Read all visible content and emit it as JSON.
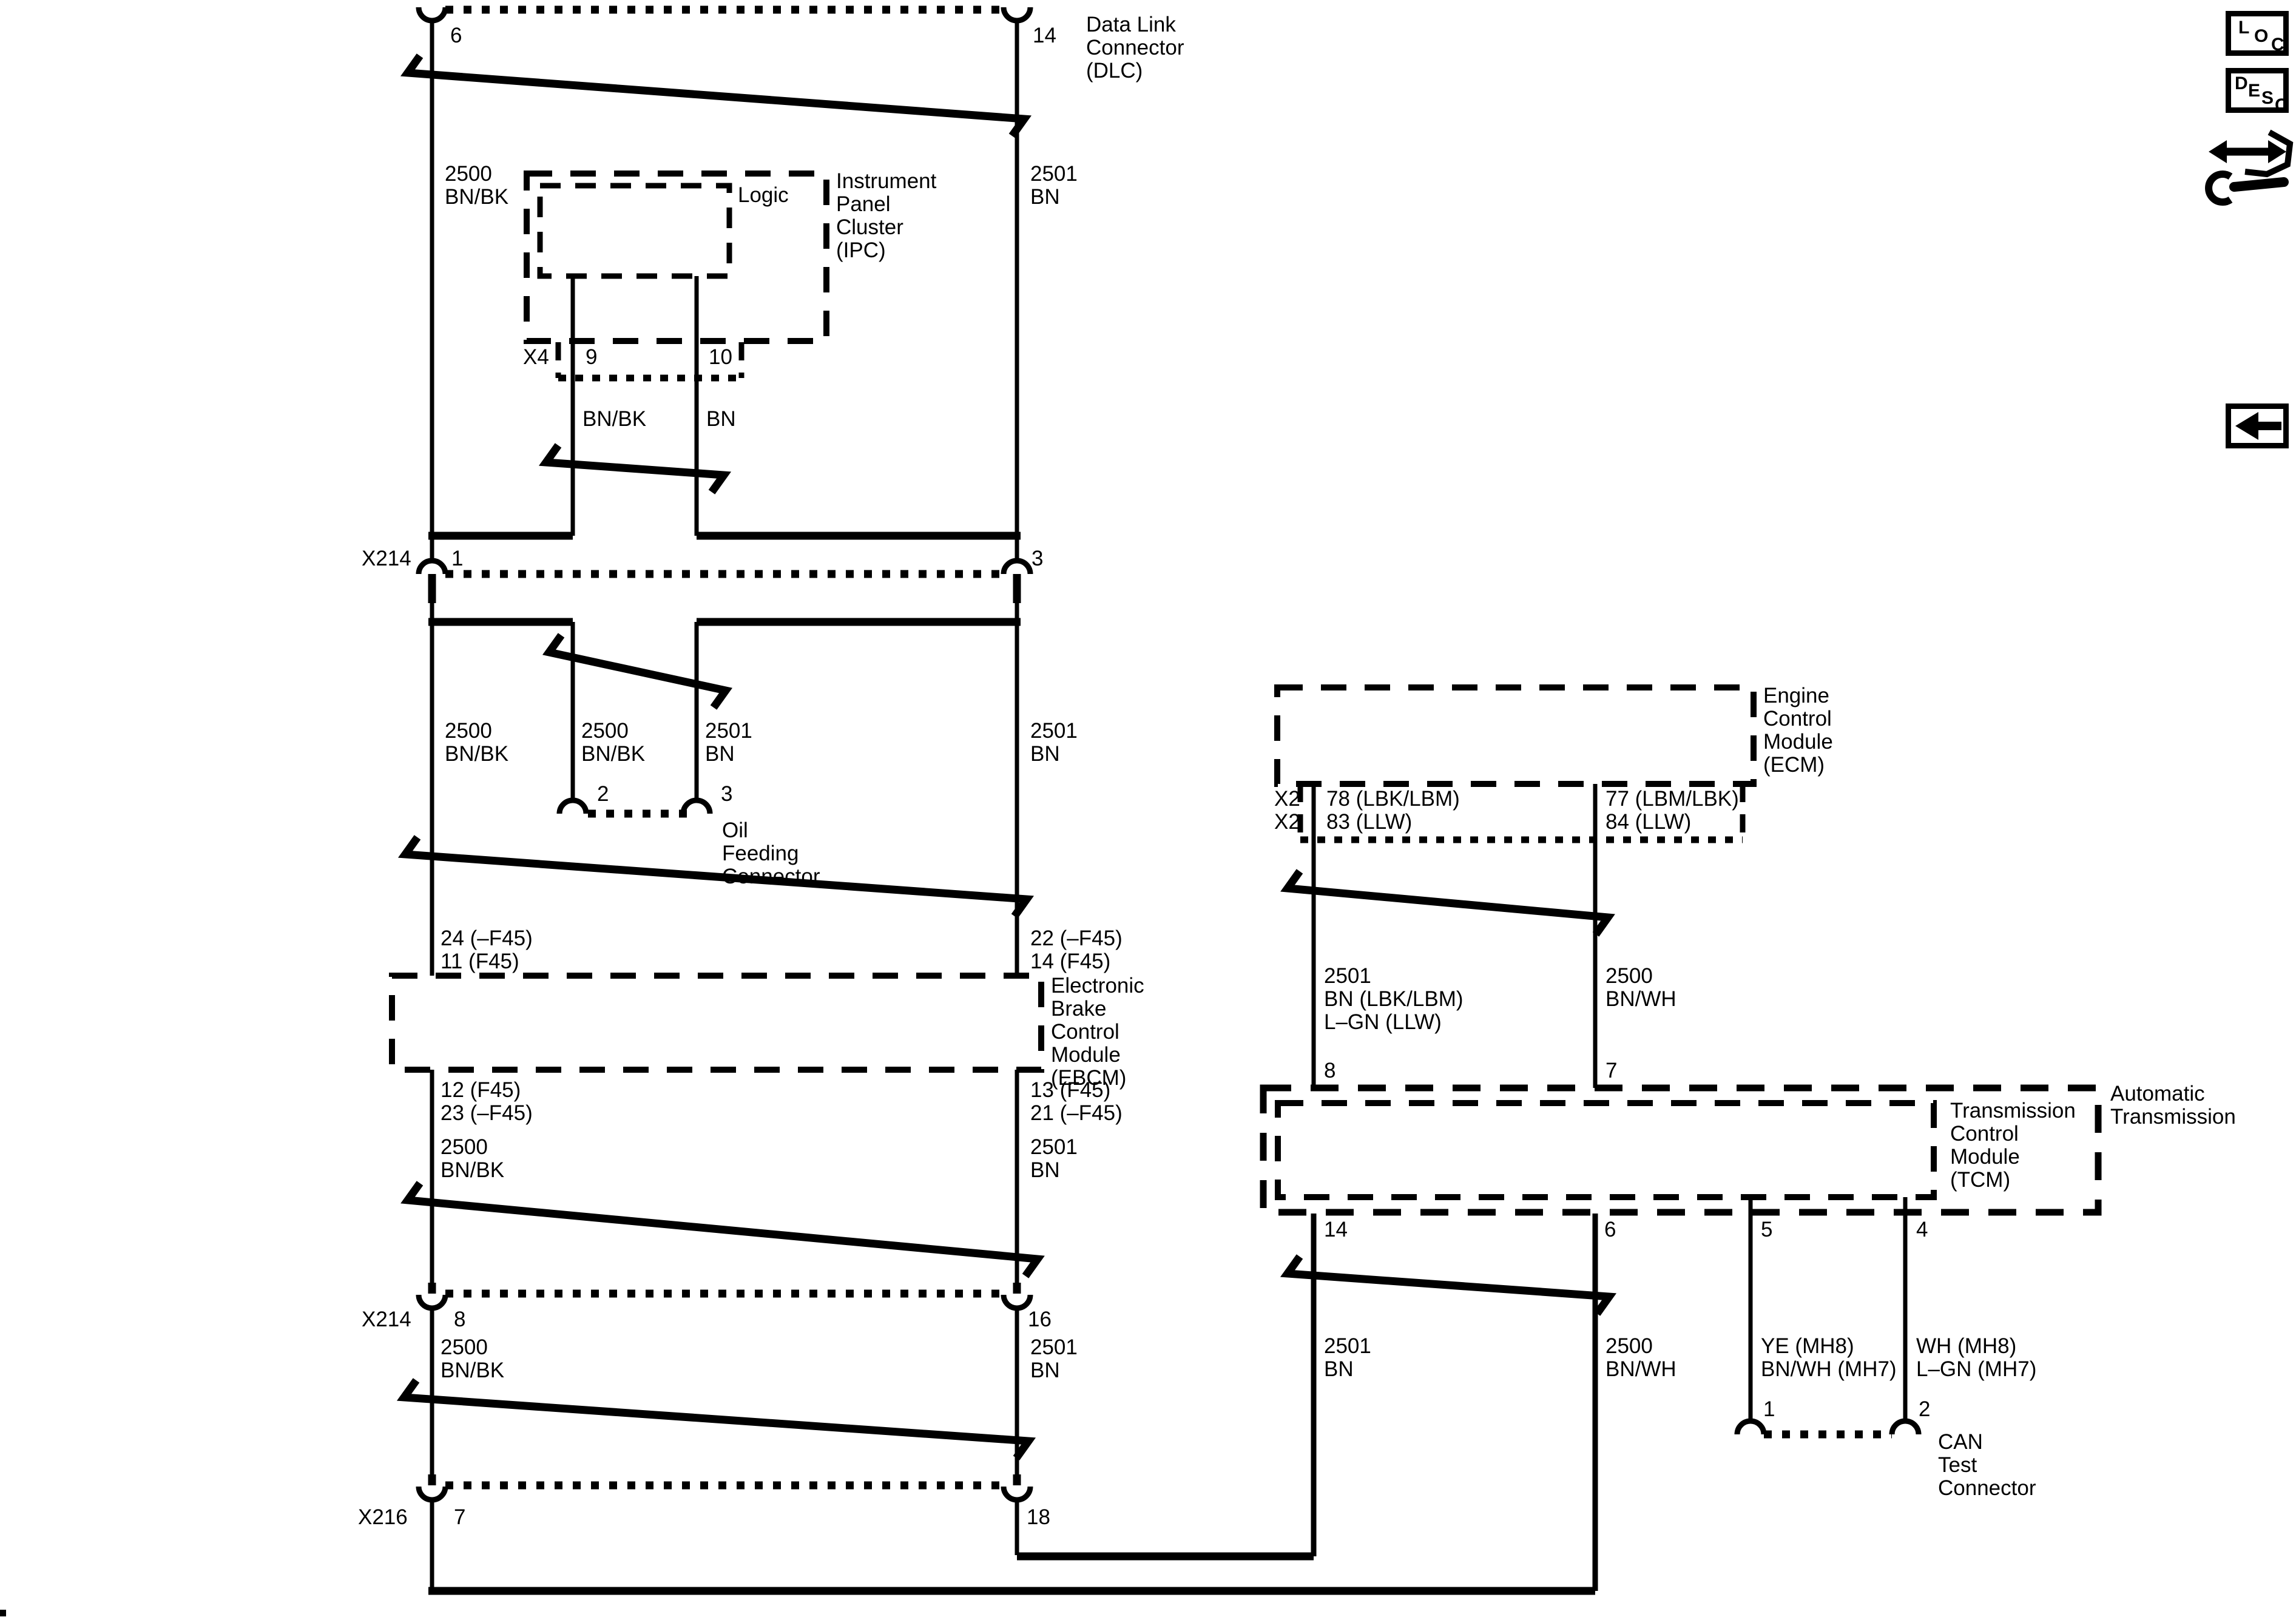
{
  "colors": {
    "ink": "#000000",
    "paper": "#ffffff"
  },
  "labels": {
    "dlc": {
      "pin6": "6",
      "pin14": "14",
      "name": "Data Link\nConnector\n(DLC)"
    },
    "wires_top": {
      "w2500": "2500\nBN/BK",
      "w2501": "2501\nBN"
    },
    "ipc": {
      "logic": "Logic",
      "name": "Instrument\nPanel\nCluster\n(IPC)",
      "x4": "X4",
      "pin9": "9",
      "pin10": "10",
      "wire9": "BN/BK",
      "wire10": "BN"
    },
    "x214a": {
      "name": "X214",
      "pin1": "1",
      "pin3": "3"
    },
    "wires_mid": {
      "w2500_main": "2500\nBN/BK",
      "w2500_branch": "2500\nBN/BK",
      "w2501_branch": "2501\nBN",
      "w2501_main": "2501\nBN"
    },
    "oil": {
      "pin2": "2",
      "pin3": "3",
      "name": "Oil\nFeeding\nConnector"
    },
    "ebcm": {
      "pin24": "24 (–F45)\n11 (F45)",
      "pin22": "22 (–F45)\n14 (F45)",
      "name": "Electronic\nBrake\nControl\nModule\n(EBCM)",
      "pin12": "12 (F45)\n23 (–F45)",
      "pin13": "13 (F45)\n21 (–F45)",
      "w2500": "2500\nBN/BK",
      "w2501": "2501\nBN"
    },
    "x214b": {
      "name": "X214",
      "pin8": "8",
      "pin16": "16",
      "w2500": "2500\nBN/BK",
      "w2501": "2501\nBN"
    },
    "x216": {
      "name": "X216",
      "pin7": "7",
      "pin18": "18"
    },
    "ecm": {
      "name": "Engine\nControl\nModule\n(ECM)",
      "x2": "X2\nX2",
      "pin78": "78 (LBK/LBM)\n83 (LLW)",
      "pin77": "77 (LBM/LBK)\n84 (LLW)"
    },
    "tcm": {
      "w2501_in": "2501\nBN (LBK/LBM)\nL–GN (LLW)",
      "w2500_in": "2500\nBN/WH",
      "pin8": "8",
      "pin7": "7",
      "name": "Transmission\nControl\nModule\n(TCM)",
      "outer_name": "Automatic\nTransmission",
      "pin14": "14",
      "pin6": "6",
      "pin5": "5",
      "pin4": "4",
      "w2501_out": "2501\nBN",
      "w2500_out": "2500\nBN/WH",
      "w_ye": "YE (MH8)\nBN/WH (MH7)",
      "w_wh": "WH (MH8)\nL–GN (MH7)"
    },
    "can": {
      "pin1": "1",
      "pin2": "2",
      "name": "CAN\nTest\nConnector"
    }
  },
  "toolbar": {
    "loc": "LOC",
    "desc": "DESC",
    "icons": [
      "loc-button",
      "desc-button",
      "compare-wrench-icon",
      "back-arrow-button"
    ]
  }
}
